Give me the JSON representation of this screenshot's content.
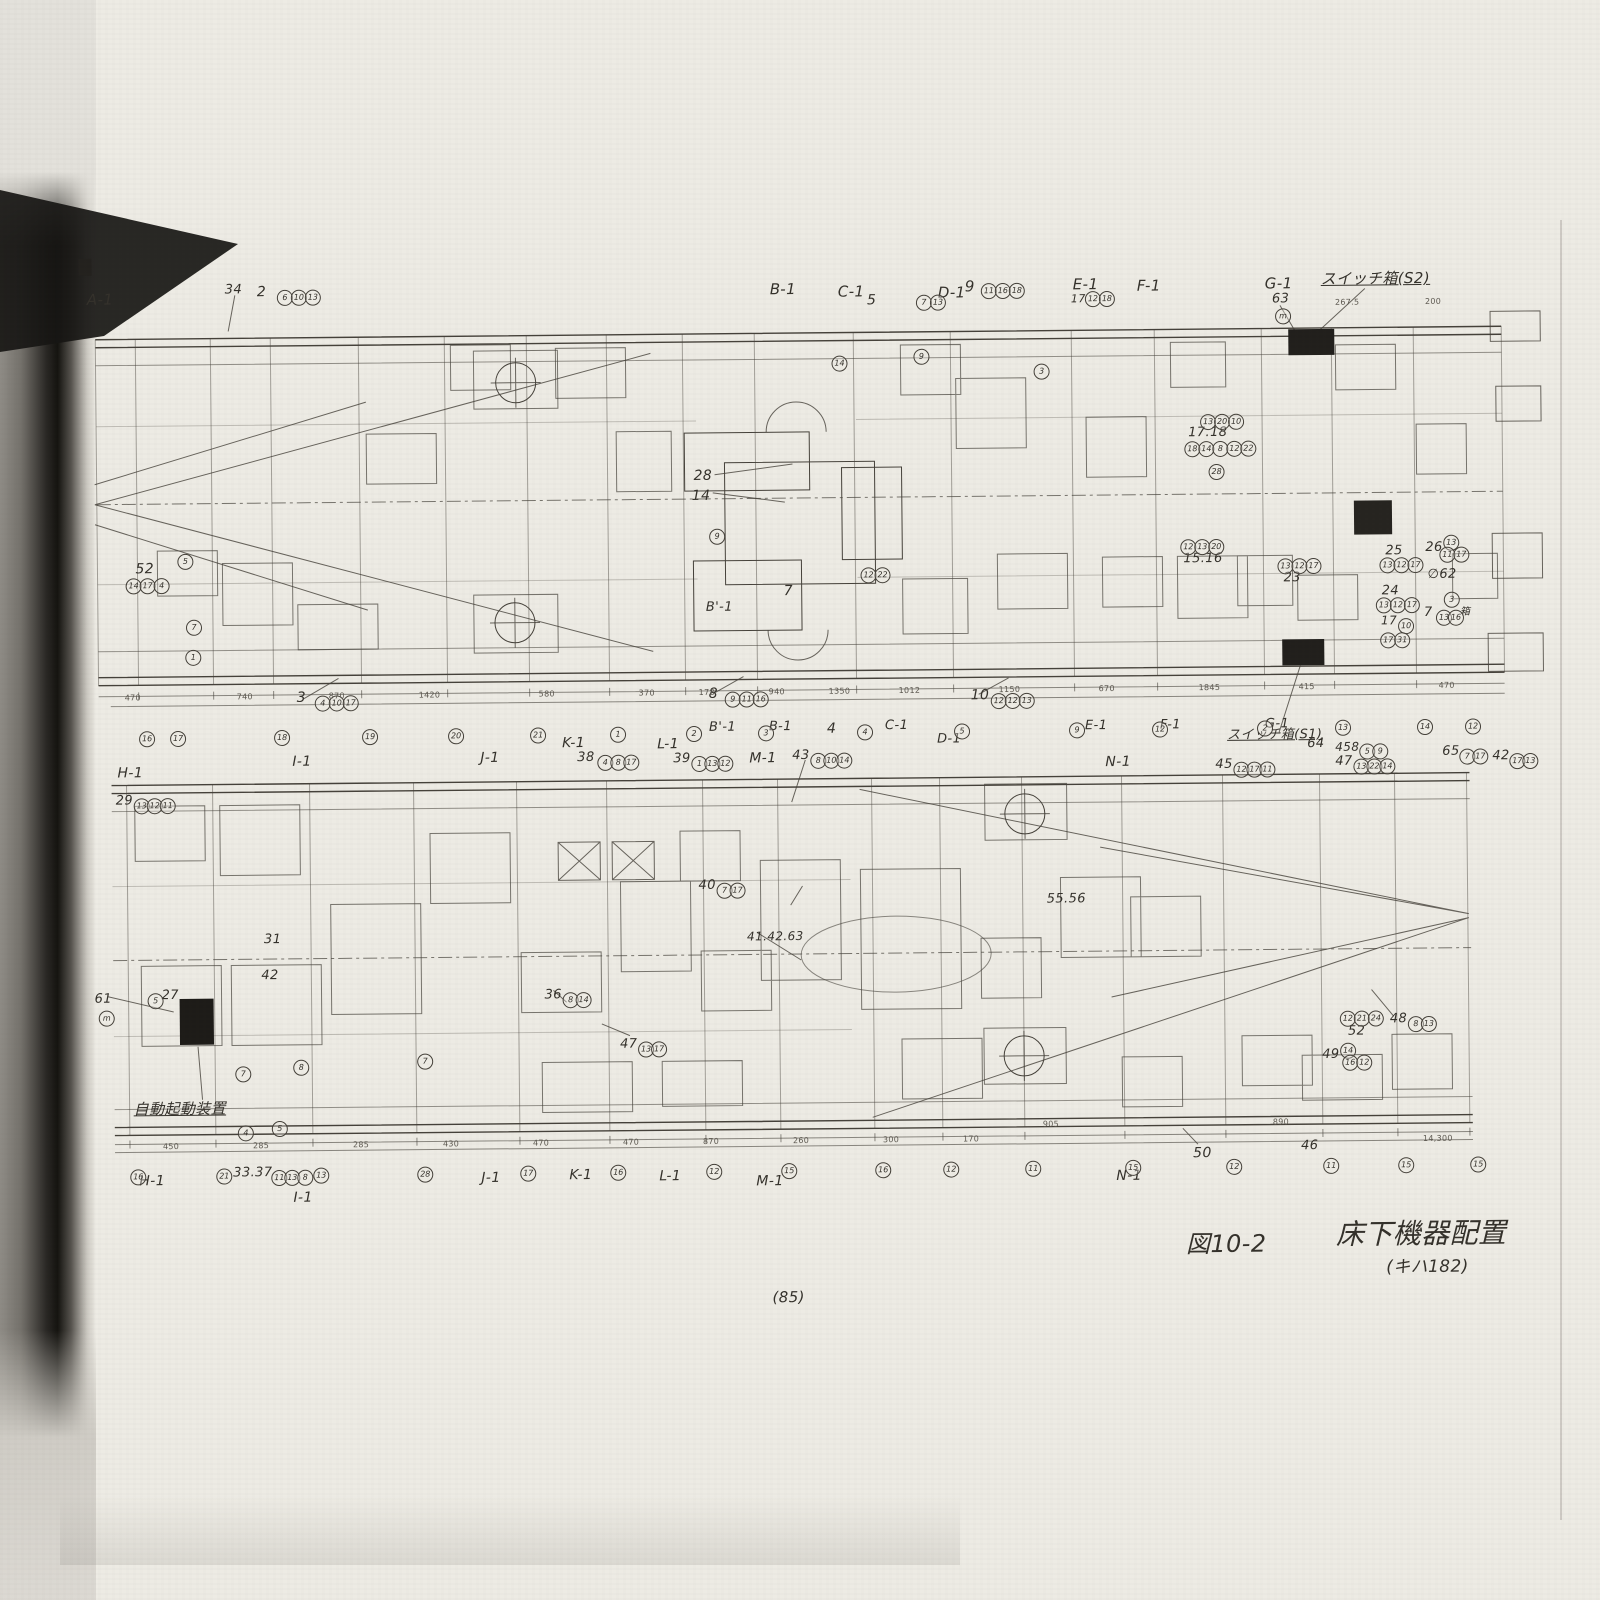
{
  "caption": {
    "figure": "図10-2",
    "title": "床下機器配置",
    "subtitle": "(キハ182)"
  },
  "page": {
    "number": "(85)"
  },
  "labels": [
    {
      "t": "A-1",
      "x": 92,
      "y": 286
    },
    {
      "t": "34",
      "x": 230,
      "y": 278,
      "fs": 13
    },
    {
      "t": "2",
      "x": 262,
      "y": 280,
      "fs": 14
    },
    {
      "t": "B-1",
      "x": 775,
      "y": 282
    },
    {
      "t": "C-1",
      "x": 843,
      "y": 285
    },
    {
      "t": "5",
      "x": 872,
      "y": 294,
      "fs": 14
    },
    {
      "t": "D-1",
      "x": 943,
      "y": 287
    },
    {
      "t": "9",
      "x": 970,
      "y": 281,
      "fs": 15
    },
    {
      "t": "E-1",
      "x": 1078,
      "y": 280
    },
    {
      "t": "17",
      "x": 1076,
      "y": 296,
      "fs": 11
    },
    {
      "t": "F-1",
      "x": 1142,
      "y": 282
    },
    {
      "t": "G-1",
      "x": 1270,
      "y": 281
    },
    {
      "t": "63",
      "x": 1277,
      "y": 297,
      "fs": 13
    },
    {
      "t": "スイッチ箱(S2)",
      "x": 1326,
      "y": 277,
      "cls": "u",
      "fs": 15
    },
    {
      "t": "52",
      "x": 138,
      "y": 556,
      "fs": 14
    },
    {
      "t": "28",
      "x": 697,
      "y": 468,
      "fs": 14
    },
    {
      "t": "14",
      "x": 695,
      "y": 488,
      "fs": 14
    },
    {
      "t": "7",
      "x": 786,
      "y": 584,
      "fs": 14
    },
    {
      "t": "B'-1",
      "x": 708,
      "y": 600,
      "fs": 13
    },
    {
      "t": "15.16",
      "x": 1186,
      "y": 556,
      "fs": 13
    },
    {
      "t": "17.18",
      "x": 1192,
      "y": 430,
      "fs": 13
    },
    {
      "t": "23",
      "x": 1286,
      "y": 576,
      "fs": 13
    },
    {
      "t": "25",
      "x": 1388,
      "y": 550,
      "fs": 13
    },
    {
      "t": "24",
      "x": 1384,
      "y": 590,
      "fs": 13
    },
    {
      "t": "26",
      "x": 1428,
      "y": 547,
      "fs": 13
    },
    {
      "t": "∅62",
      "x": 1430,
      "y": 574,
      "fs": 13
    },
    {
      "t": "7",
      "x": 1426,
      "y": 612,
      "fs": 13
    },
    {
      "t": "箱",
      "x": 1462,
      "y": 614,
      "fs": 10
    },
    {
      "t": "17",
      "x": 1383,
      "y": 620,
      "fs": 12
    },
    {
      "t": "3",
      "x": 298,
      "y": 686,
      "fs": 14
    },
    {
      "t": "8",
      "x": 710,
      "y": 686,
      "fs": 14
    },
    {
      "t": "10",
      "x": 972,
      "y": 690,
      "fs": 14
    },
    {
      "t": "B'-1",
      "x": 710,
      "y": 720,
      "fs": 13
    },
    {
      "t": "B-1",
      "x": 770,
      "y": 720,
      "fs": 13
    },
    {
      "t": "4",
      "x": 828,
      "y": 722,
      "fs": 14
    },
    {
      "t": "C-1",
      "x": 886,
      "y": 720,
      "fs": 13
    },
    {
      "t": "D-1",
      "x": 938,
      "y": 734,
      "fs": 13
    },
    {
      "t": "E-1",
      "x": 1086,
      "y": 722,
      "fs": 13
    },
    {
      "t": "F-1",
      "x": 1161,
      "y": 722,
      "fs": 13
    },
    {
      "t": "G-1",
      "x": 1266,
      "y": 722,
      "fs": 13
    },
    {
      "t": "スイッチ箱(S1)",
      "x": 1228,
      "y": 733,
      "cls": "u",
      "fs": 13
    },
    {
      "t": "64",
      "x": 1308,
      "y": 742,
      "fs": 13
    },
    {
      "t": "458",
      "x": 1336,
      "y": 746,
      "fs": 12
    },
    {
      "t": "H-1",
      "x": 118,
      "y": 760,
      "fs": 14
    },
    {
      "t": "I-1",
      "x": 293,
      "y": 750,
      "fs": 14
    },
    {
      "t": "J-1",
      "x": 481,
      "y": 748,
      "fs": 14
    },
    {
      "t": "K-1",
      "x": 563,
      "y": 734,
      "fs": 14
    },
    {
      "t": "38",
      "x": 578,
      "y": 749,
      "fs": 13
    },
    {
      "t": "L-1",
      "x": 658,
      "y": 736,
      "fs": 14
    },
    {
      "t": "39",
      "x": 674,
      "y": 751,
      "fs": 13
    },
    {
      "t": "M-1",
      "x": 750,
      "y": 751,
      "fs": 14
    },
    {
      "t": "43",
      "x": 793,
      "y": 749,
      "fs": 13
    },
    {
      "t": "N-1",
      "x": 1106,
      "y": 758,
      "fs": 14
    },
    {
      "t": "45",
      "x": 1216,
      "y": 762,
      "fs": 13
    },
    {
      "t": "47",
      "x": 1336,
      "y": 760,
      "fs": 13
    },
    {
      "t": "65",
      "x": 1443,
      "y": 751,
      "fs": 13
    },
    {
      "t": "42",
      "x": 1493,
      "y": 756,
      "fs": 13
    },
    {
      "t": "29",
      "x": 116,
      "y": 788,
      "fs": 13
    },
    {
      "t": "61",
      "x": 93,
      "y": 986,
      "fs": 13
    },
    {
      "t": "27",
      "x": 160,
      "y": 983,
      "fs": 13
    },
    {
      "t": "42",
      "x": 260,
      "y": 964,
      "fs": 13
    },
    {
      "t": "31",
      "x": 263,
      "y": 928,
      "fs": 13
    },
    {
      "t": "自動起動装置",
      "x": 131,
      "y": 1096,
      "cls": "u",
      "fs": 15
    },
    {
      "t": "41.42.63",
      "x": 746,
      "y": 930,
      "fs": 12
    },
    {
      "t": "40",
      "x": 698,
      "y": 878,
      "fs": 13
    },
    {
      "t": "36",
      "x": 543,
      "y": 986,
      "fs": 13
    },
    {
      "t": "47",
      "x": 618,
      "y": 1036,
      "fs": 13
    },
    {
      "t": "55.56",
      "x": 1046,
      "y": 895,
      "fs": 13
    },
    {
      "t": "48",
      "x": 1388,
      "y": 1018,
      "fs": 13
    },
    {
      "t": "52",
      "x": 1346,
      "y": 1030,
      "fs": 13
    },
    {
      "t": "49",
      "x": 1320,
      "y": 1053,
      "fs": 13
    },
    {
      "t": "50",
      "x": 1190,
      "y": 1150,
      "fs": 14
    },
    {
      "t": "46",
      "x": 1298,
      "y": 1144,
      "fs": 13
    },
    {
      "t": "H-1",
      "x": 136,
      "y": 1168,
      "fs": 14
    },
    {
      "t": "33.37",
      "x": 230,
      "y": 1161,
      "fs": 13
    },
    {
      "t": "I-1",
      "x": 290,
      "y": 1186,
      "fs": 14
    },
    {
      "t": "J-1",
      "x": 478,
      "y": 1168,
      "fs": 14
    },
    {
      "t": "K-1",
      "x": 566,
      "y": 1166,
      "fs": 14
    },
    {
      "t": "L-1",
      "x": 656,
      "y": 1168,
      "fs": 14
    },
    {
      "t": "M-1",
      "x": 753,
      "y": 1174,
      "fs": 14
    },
    {
      "t": "N-1",
      "x": 1113,
      "y": 1172,
      "fs": 14
    }
  ],
  "circles": [
    {
      "v": "6",
      "x": 282,
      "y": 285
    },
    {
      "v": "10",
      "x": 296,
      "y": 285
    },
    {
      "v": "13",
      "x": 310,
      "y": 285
    },
    {
      "v": "7",
      "x": 921,
      "y": 296
    },
    {
      "v": "13",
      "x": 935,
      "y": 296
    },
    {
      "v": "11",
      "x": 986,
      "y": 285
    },
    {
      "v": "16",
      "x": 1000,
      "y": 285
    },
    {
      "v": "18",
      "x": 1014,
      "y": 285
    },
    {
      "v": "12",
      "x": 1090,
      "y": 294
    },
    {
      "v": "18",
      "x": 1104,
      "y": 294
    },
    {
      "v": "m",
      "x": 1280,
      "y": 313
    },
    {
      "v": "14",
      "x": 128,
      "y": 572
    },
    {
      "v": "17",
      "x": 142,
      "y": 572
    },
    {
      "v": "4",
      "x": 156,
      "y": 572
    },
    {
      "v": "5",
      "x": 180,
      "y": 548
    },
    {
      "v": "7",
      "x": 188,
      "y": 614
    },
    {
      "v": "1",
      "x": 187,
      "y": 644
    },
    {
      "v": "12",
      "x": 863,
      "y": 568
    },
    {
      "v": "22",
      "x": 877,
      "y": 568
    },
    {
      "v": "14",
      "x": 836,
      "y": 356
    },
    {
      "v": "3",
      "x": 1038,
      "y": 366
    },
    {
      "v": "9",
      "x": 918,
      "y": 350
    },
    {
      "v": "9",
      "x": 712,
      "y": 528
    },
    {
      "v": "12",
      "x": 1183,
      "y": 543
    },
    {
      "v": "13",
      "x": 1197,
      "y": 543
    },
    {
      "v": "20",
      "x": 1211,
      "y": 543
    },
    {
      "v": "13",
      "x": 1204,
      "y": 418
    },
    {
      "v": "20",
      "x": 1218,
      "y": 418
    },
    {
      "v": "10",
      "x": 1232,
      "y": 418
    },
    {
      "v": "18",
      "x": 1188,
      "y": 445
    },
    {
      "v": "14",
      "x": 1202,
      "y": 445
    },
    {
      "v": "8",
      "x": 1216,
      "y": 445
    },
    {
      "v": "12",
      "x": 1230,
      "y": 445
    },
    {
      "v": "22",
      "x": 1244,
      "y": 445
    },
    {
      "v": "28",
      "x": 1212,
      "y": 468
    },
    {
      "v": "13",
      "x": 1280,
      "y": 563
    },
    {
      "v": "12",
      "x": 1294,
      "y": 563
    },
    {
      "v": "17",
      "x": 1308,
      "y": 563
    },
    {
      "v": "13",
      "x": 1382,
      "y": 563
    },
    {
      "v": "12",
      "x": 1396,
      "y": 563
    },
    {
      "v": "17",
      "x": 1410,
      "y": 563
    },
    {
      "v": "13",
      "x": 1378,
      "y": 603
    },
    {
      "v": "12",
      "x": 1392,
      "y": 603
    },
    {
      "v": "17",
      "x": 1406,
      "y": 603
    },
    {
      "v": "13",
      "x": 1446,
      "y": 541
    },
    {
      "v": "11",
      "x": 1442,
      "y": 553
    },
    {
      "v": "17",
      "x": 1456,
      "y": 553
    },
    {
      "v": "3",
      "x": 1446,
      "y": 598
    },
    {
      "v": "13",
      "x": 1438,
      "y": 616
    },
    {
      "v": "16",
      "x": 1450,
      "y": 616
    },
    {
      "v": "10",
      "x": 1400,
      "y": 624
    },
    {
      "v": "17",
      "x": 1382,
      "y": 638
    },
    {
      "v": "31",
      "x": 1396,
      "y": 638
    },
    {
      "v": "4",
      "x": 316,
      "y": 691
    },
    {
      "v": "10",
      "x": 330,
      "y": 691
    },
    {
      "v": "17",
      "x": 344,
      "y": 691
    },
    {
      "v": "9",
      "x": 726,
      "y": 691
    },
    {
      "v": "11",
      "x": 740,
      "y": 691
    },
    {
      "v": "16",
      "x": 754,
      "y": 691
    },
    {
      "v": "12",
      "x": 992,
      "y": 695
    },
    {
      "v": "12",
      "x": 1006,
      "y": 695
    },
    {
      "v": "13",
      "x": 1020,
      "y": 695
    },
    {
      "v": "5",
      "x": 1360,
      "y": 749
    },
    {
      "v": "9",
      "x": 1373,
      "y": 749
    },
    {
      "v": "16",
      "x": 140,
      "y": 725
    },
    {
      "v": "17",
      "x": 171,
      "y": 725
    },
    {
      "v": "18",
      "x": 275,
      "y": 725
    },
    {
      "v": "19",
      "x": 363,
      "y": 725
    },
    {
      "v": "20",
      "x": 449,
      "y": 725
    },
    {
      "v": "21",
      "x": 531,
      "y": 725
    },
    {
      "v": "1",
      "x": 611,
      "y": 725
    },
    {
      "v": "2",
      "x": 687,
      "y": 725
    },
    {
      "v": "3",
      "x": 759,
      "y": 725
    },
    {
      "v": "4",
      "x": 858,
      "y": 725
    },
    {
      "v": "5",
      "x": 955,
      "y": 725
    },
    {
      "v": "9",
      "x": 1070,
      "y": 725
    },
    {
      "v": "12",
      "x": 1153,
      "y": 725
    },
    {
      "v": "2",
      "x": 1258,
      "y": 725
    },
    {
      "v": "13",
      "x": 1336,
      "y": 725
    },
    {
      "v": "14",
      "x": 1418,
      "y": 725
    },
    {
      "v": "12",
      "x": 1466,
      "y": 725
    },
    {
      "v": "4",
      "x": 598,
      "y": 753
    },
    {
      "v": "8",
      "x": 611,
      "y": 753
    },
    {
      "v": "17",
      "x": 624,
      "y": 753
    },
    {
      "v": "1",
      "x": 692,
      "y": 755
    },
    {
      "v": "13",
      "x": 705,
      "y": 755
    },
    {
      "v": "12",
      "x": 718,
      "y": 755
    },
    {
      "v": "8",
      "x": 811,
      "y": 753
    },
    {
      "v": "10",
      "x": 824,
      "y": 753
    },
    {
      "v": "14",
      "x": 837,
      "y": 753
    },
    {
      "v": "12",
      "x": 1234,
      "y": 766
    },
    {
      "v": "17",
      "x": 1247,
      "y": 766
    },
    {
      "v": "11",
      "x": 1260,
      "y": 766
    },
    {
      "v": "13",
      "x": 1354,
      "y": 764
    },
    {
      "v": "22",
      "x": 1367,
      "y": 764
    },
    {
      "v": "14",
      "x": 1380,
      "y": 764
    },
    {
      "v": "7",
      "x": 1460,
      "y": 755
    },
    {
      "v": "17",
      "x": 1473,
      "y": 755
    },
    {
      "v": "17",
      "x": 1510,
      "y": 760
    },
    {
      "v": "13",
      "x": 1523,
      "y": 760
    },
    {
      "v": "13",
      "x": 134,
      "y": 792
    },
    {
      "v": "12",
      "x": 147,
      "y": 792
    },
    {
      "v": "11",
      "x": 160,
      "y": 792
    },
    {
      "v": "m",
      "x": 97,
      "y": 1004
    },
    {
      "v": "5",
      "x": 146,
      "y": 987
    },
    {
      "v": "7",
      "x": 233,
      "y": 1061
    },
    {
      "v": "8",
      "x": 291,
      "y": 1055
    },
    {
      "v": "4",
      "x": 235,
      "y": 1120
    },
    {
      "v": "5",
      "x": 269,
      "y": 1116
    },
    {
      "v": "7",
      "x": 415,
      "y": 1050
    },
    {
      "v": "7",
      "x": 716,
      "y": 882
    },
    {
      "v": "17",
      "x": 729,
      "y": 882
    },
    {
      "v": "8",
      "x": 561,
      "y": 990
    },
    {
      "v": "14",
      "x": 574,
      "y": 990
    },
    {
      "v": "13",
      "x": 636,
      "y": 1040
    },
    {
      "v": "17",
      "x": 649,
      "y": 1040
    },
    {
      "v": "12",
      "x": 1338,
      "y": 1016
    },
    {
      "v": "21",
      "x": 1352,
      "y": 1016
    },
    {
      "v": "24",
      "x": 1366,
      "y": 1016
    },
    {
      "v": "8",
      "x": 1406,
      "y": 1022
    },
    {
      "v": "13",
      "x": 1419,
      "y": 1022
    },
    {
      "v": "14",
      "x": 1338,
      "y": 1048
    },
    {
      "v": "16",
      "x": 1340,
      "y": 1060
    },
    {
      "v": "12",
      "x": 1354,
      "y": 1060
    },
    {
      "v": "11",
      "x": 268,
      "y": 1165
    },
    {
      "v": "13",
      "x": 281,
      "y": 1165
    },
    {
      "v": "8",
      "x": 294,
      "y": 1165
    },
    {
      "v": "16",
      "x": 127,
      "y": 1163
    },
    {
      "v": "21",
      "x": 213,
      "y": 1163
    },
    {
      "v": "13",
      "x": 310,
      "y": 1163
    },
    {
      "v": "28",
      "x": 414,
      "y": 1163
    },
    {
      "v": "17",
      "x": 517,
      "y": 1163
    },
    {
      "v": "16",
      "x": 607,
      "y": 1163
    },
    {
      "v": "12",
      "x": 703,
      "y": 1163
    },
    {
      "v": "15",
      "x": 778,
      "y": 1163
    },
    {
      "v": "16",
      "x": 872,
      "y": 1163
    },
    {
      "v": "12",
      "x": 940,
      "y": 1163
    },
    {
      "v": "11",
      "x": 1022,
      "y": 1163
    },
    {
      "v": "15",
      "x": 1122,
      "y": 1163
    },
    {
      "v": "12",
      "x": 1223,
      "y": 1163
    },
    {
      "v": "11",
      "x": 1320,
      "y": 1163
    },
    {
      "v": "15",
      "x": 1395,
      "y": 1163
    },
    {
      "v": "15",
      "x": 1467,
      "y": 1163
    }
  ],
  "dims": [
    {
      "t": "470",
      "x": 126,
      "y": 687
    },
    {
      "t": "740",
      "x": 238,
      "y": 687
    },
    {
      "t": "870",
      "x": 330,
      "y": 687
    },
    {
      "t": "1420",
      "x": 420,
      "y": 687
    },
    {
      "t": "580",
      "x": 540,
      "y": 687
    },
    {
      "t": "370",
      "x": 640,
      "y": 687
    },
    {
      "t": "178",
      "x": 700,
      "y": 687
    },
    {
      "t": "940",
      "x": 770,
      "y": 687
    },
    {
      "t": "1350",
      "x": 830,
      "y": 687
    },
    {
      "t": "1012",
      "x": 900,
      "y": 687
    },
    {
      "t": "1150",
      "x": 1000,
      "y": 687
    },
    {
      "t": "670",
      "x": 1100,
      "y": 687
    },
    {
      "t": "1845",
      "x": 1200,
      "y": 687
    },
    {
      "t": "415",
      "x": 1300,
      "y": 687
    },
    {
      "t": "470",
      "x": 1440,
      "y": 687
    },
    {
      "t": "267.5",
      "x": 1340,
      "y": 303
    },
    {
      "t": "200",
      "x": 1430,
      "y": 303
    },
    {
      "t": "450",
      "x": 160,
      "y": 1136
    },
    {
      "t": "285",
      "x": 250,
      "y": 1136
    },
    {
      "t": "285",
      "x": 350,
      "y": 1136
    },
    {
      "t": "430",
      "x": 440,
      "y": 1136
    },
    {
      "t": "470",
      "x": 530,
      "y": 1136
    },
    {
      "t": "470",
      "x": 620,
      "y": 1136
    },
    {
      "t": "870",
      "x": 700,
      "y": 1136
    },
    {
      "t": "260",
      "x": 790,
      "y": 1136
    },
    {
      "t": "300",
      "x": 880,
      "y": 1136
    },
    {
      "t": "170",
      "x": 960,
      "y": 1136
    },
    {
      "t": "905",
      "x": 1040,
      "y": 1122
    },
    {
      "t": "890",
      "x": 1270,
      "y": 1122
    },
    {
      "t": "14,300",
      "x": 1420,
      "y": 1140
    }
  ]
}
